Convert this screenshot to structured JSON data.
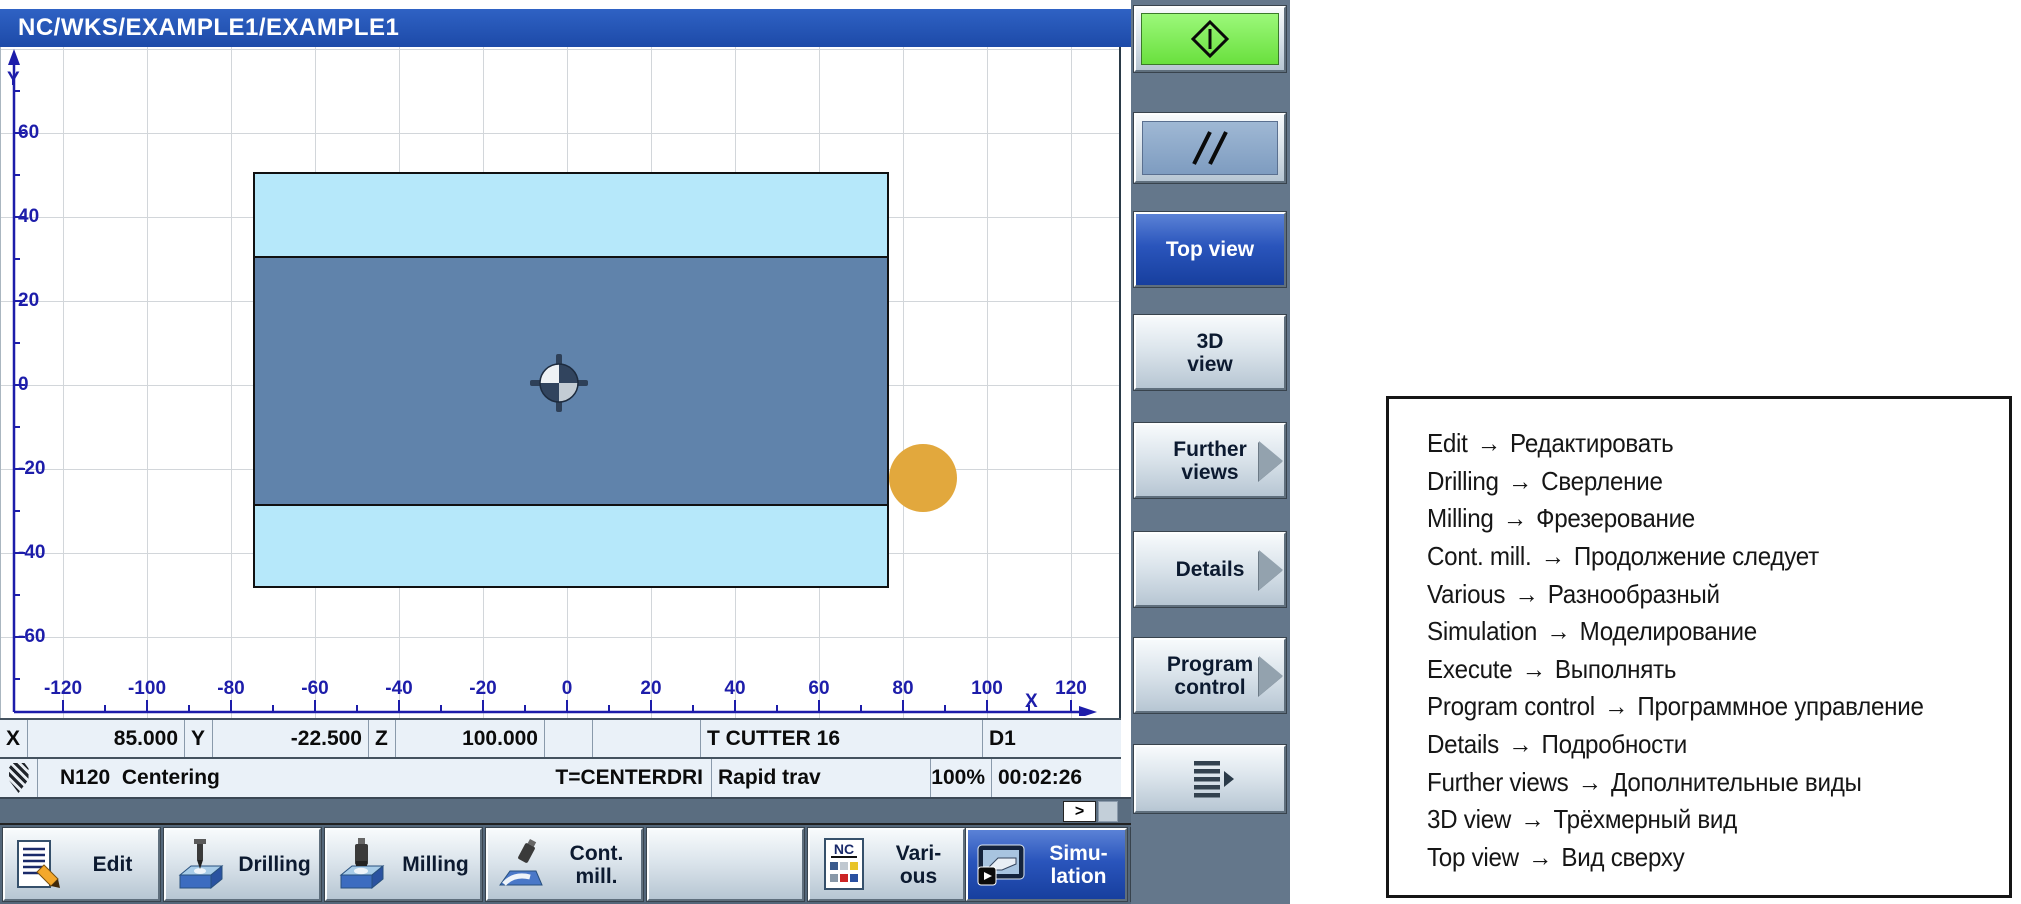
{
  "title_bar": {
    "text": "NC/WKS/EXAMPLE1/EXAMPLE1"
  },
  "plot": {
    "x_axis_label": "X",
    "y_axis_label": "Y",
    "x_ticks": [
      "-120",
      "-100",
      "-80",
      "-60",
      "-40",
      "-20",
      "0",
      "20",
      "40",
      "60",
      "80",
      "100",
      "120"
    ],
    "y_ticks": [
      "60",
      "40",
      "20",
      "0",
      "-20",
      "-40",
      "-60"
    ],
    "colors": {
      "workpiece_blank": "#b6e8fa",
      "workpiece_machined": "#6083ab",
      "tool_circle": "#e2a83d",
      "axis": "#1d1daa",
      "grid": "#d2d6da"
    }
  },
  "status_row1": {
    "x_label": "X",
    "x_value": "85.000",
    "y_label": "Y",
    "y_value": "-22.500",
    "z_label": "Z",
    "z_value": "100.000",
    "tool": "T CUTTER 16",
    "offset": "D1"
  },
  "status_row2": {
    "block": "N120",
    "operation": "Centering",
    "tool": "T=CENTERDRI",
    "feed_mode": "Rapid trav",
    "override": "100%",
    "time": "00:02:26"
  },
  "expand_button": ">",
  "bottom_softkeys": {
    "edit": {
      "label": "Edit"
    },
    "drilling": {
      "label": "Drilling"
    },
    "milling": {
      "label": "Milling"
    },
    "cont_mill": {
      "label": "Cont.\nmill."
    },
    "empty": {
      "label": ""
    },
    "various": {
      "label": "Vari-\nous"
    },
    "simulation": {
      "label": "Simu-\nlation",
      "active": true
    },
    "execute": {
      "label": "Ex-\necute"
    }
  },
  "right_softkeys": {
    "start": {
      "icon": "cycle-start"
    },
    "reset": {
      "icon": "reset-double-slash"
    },
    "top_view": {
      "label": "Top view",
      "active": true
    },
    "view_3d": {
      "label": "3D\nview"
    },
    "further_views": {
      "label": "Further\nviews",
      "has_submenu": true
    },
    "details": {
      "label": "Details",
      "has_submenu": true
    },
    "program_control": {
      "label": "Program\ncontrol",
      "has_submenu": true
    },
    "menu_extension": {
      "icon": "menu-bars",
      "has_submenu": true
    }
  },
  "legend": {
    "arrow": "→",
    "items": [
      {
        "en": "Edit",
        "ru": "Редактировать"
      },
      {
        "en": "Drilling",
        "ru": "Сверление"
      },
      {
        "en": "Milling",
        "ru": "Фрезерование"
      },
      {
        "en": "Cont. mill.",
        "ru": "Продолжение следует"
      },
      {
        "en": "Various",
        "ru": "Разнообразный"
      },
      {
        "en": "Simulation",
        "ru": "Моделирование"
      },
      {
        "en": "Execute",
        "ru": "Выполнять"
      },
      {
        "en": "Program control",
        "ru": "Программное управление"
      },
      {
        "en": "Details",
        "ru": "Подробности"
      },
      {
        "en": "Further views",
        "ru": "Дополнительные виды"
      },
      {
        "en": "3D view",
        "ru": "Трёхмерный вид"
      },
      {
        "en": "Top view",
        "ru": "Вид сверху"
      }
    ]
  }
}
